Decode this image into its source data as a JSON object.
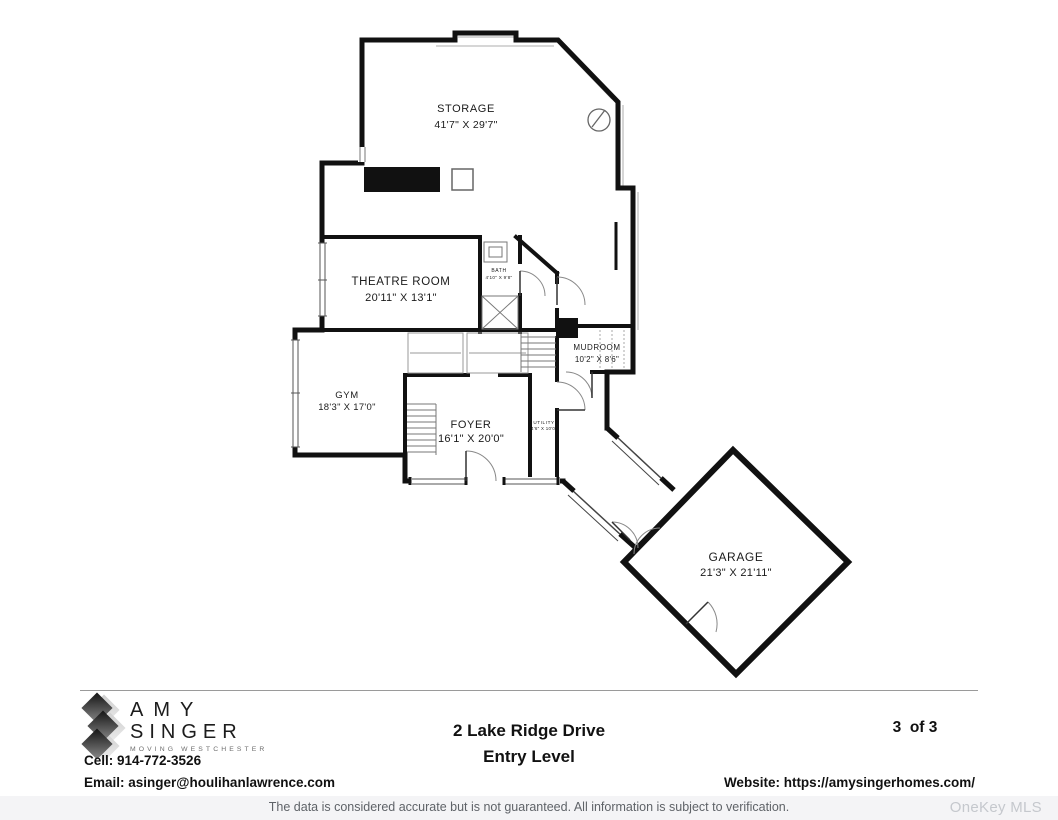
{
  "plan": {
    "rooms": [
      {
        "name": "STORAGE",
        "dims": "41'7\" X 29'7\""
      },
      {
        "name": "THEATRE ROOM",
        "dims": "20'11\" X 13'1\""
      },
      {
        "name": "BATH",
        "dims": "4'10\" X 9'8\""
      },
      {
        "name": "GYM",
        "dims": "18'3\" X 17'0\""
      },
      {
        "name": "FOYER",
        "dims": "16'1\" X 20'0\""
      },
      {
        "name": "UTILITY",
        "dims": "4'6\" X 10'0\""
      },
      {
        "name": "MUDROOM",
        "dims": "10'2\" X 8'6\""
      },
      {
        "name": "GARAGE",
        "dims": "21'3\" X 21'11\""
      }
    ]
  },
  "footer": {
    "logo": {
      "line1": "AMY",
      "line2": "SINGER",
      "tagline": "MOVING WESTCHESTER"
    },
    "cell": "Cell: 914-772-3526",
    "email": "Email: asinger@houlihanlawrence.com",
    "address": "2 Lake Ridge Drive",
    "level": "Entry Level",
    "page": "3  of 3",
    "website": "Website: https://amysingerhomes.com/"
  },
  "bottom_bar": {
    "disclaimer": "The data is considered accurate but is not guaranteed. All information is subject to verification.",
    "watermark": "OneKey MLS"
  },
  "colors": {
    "wall": "#111111",
    "accent_gray": "#c9c9c9",
    "bar_bg": "#f4f4f6"
  }
}
